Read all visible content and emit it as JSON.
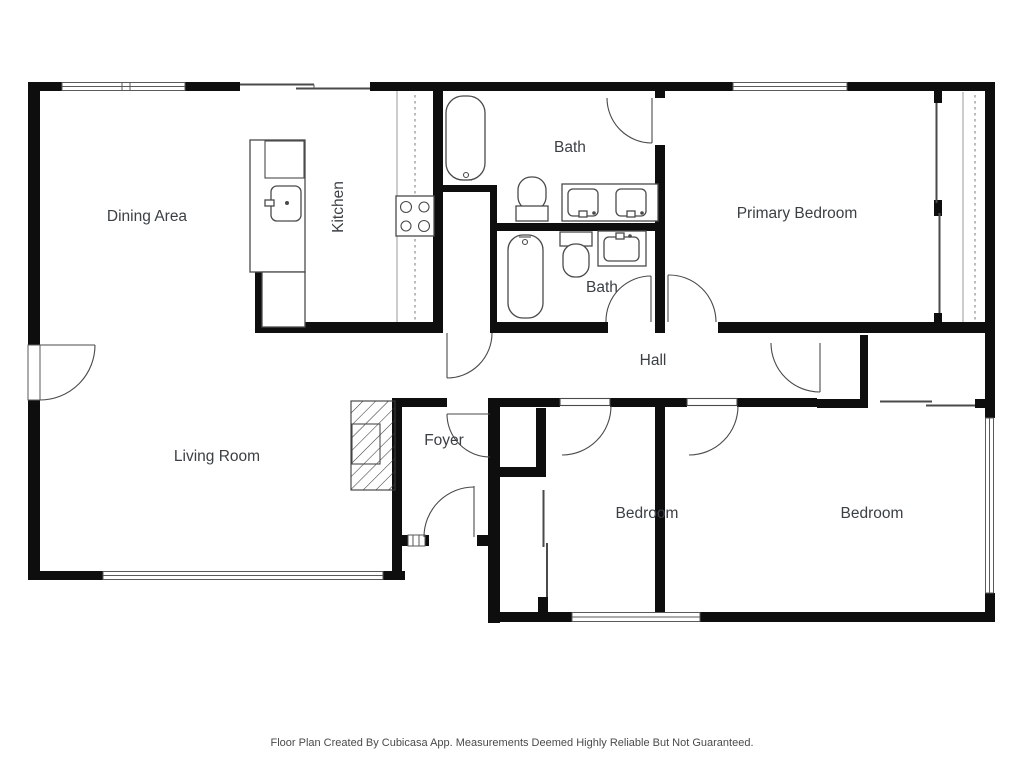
{
  "title": "Floor Plan",
  "rooms": {
    "dining": {
      "label": "Dining Area"
    },
    "kitchen": {
      "label": "Kitchen"
    },
    "bath_upper": {
      "label": "Bath"
    },
    "primary_bedroom": {
      "label": "Primary Bedroom"
    },
    "bath_lower": {
      "label": "Bath"
    },
    "hall": {
      "label": "Hall"
    },
    "living": {
      "label": "Living Room"
    },
    "foyer": {
      "label": "Foyer"
    },
    "bedroom_left": {
      "label": "Bedroom"
    },
    "bedroom_right": {
      "label": "Bedroom"
    }
  },
  "footer": {
    "text": "Floor Plan Created By Cubicasa App. Measurements Deemed Highly Reliable But Not Guaranteed."
  },
  "palette": {
    "wall": "#0e0e0e",
    "fixture_line": "#4a4a4a",
    "label_text": "#3b4045",
    "background": "#ffffff"
  }
}
